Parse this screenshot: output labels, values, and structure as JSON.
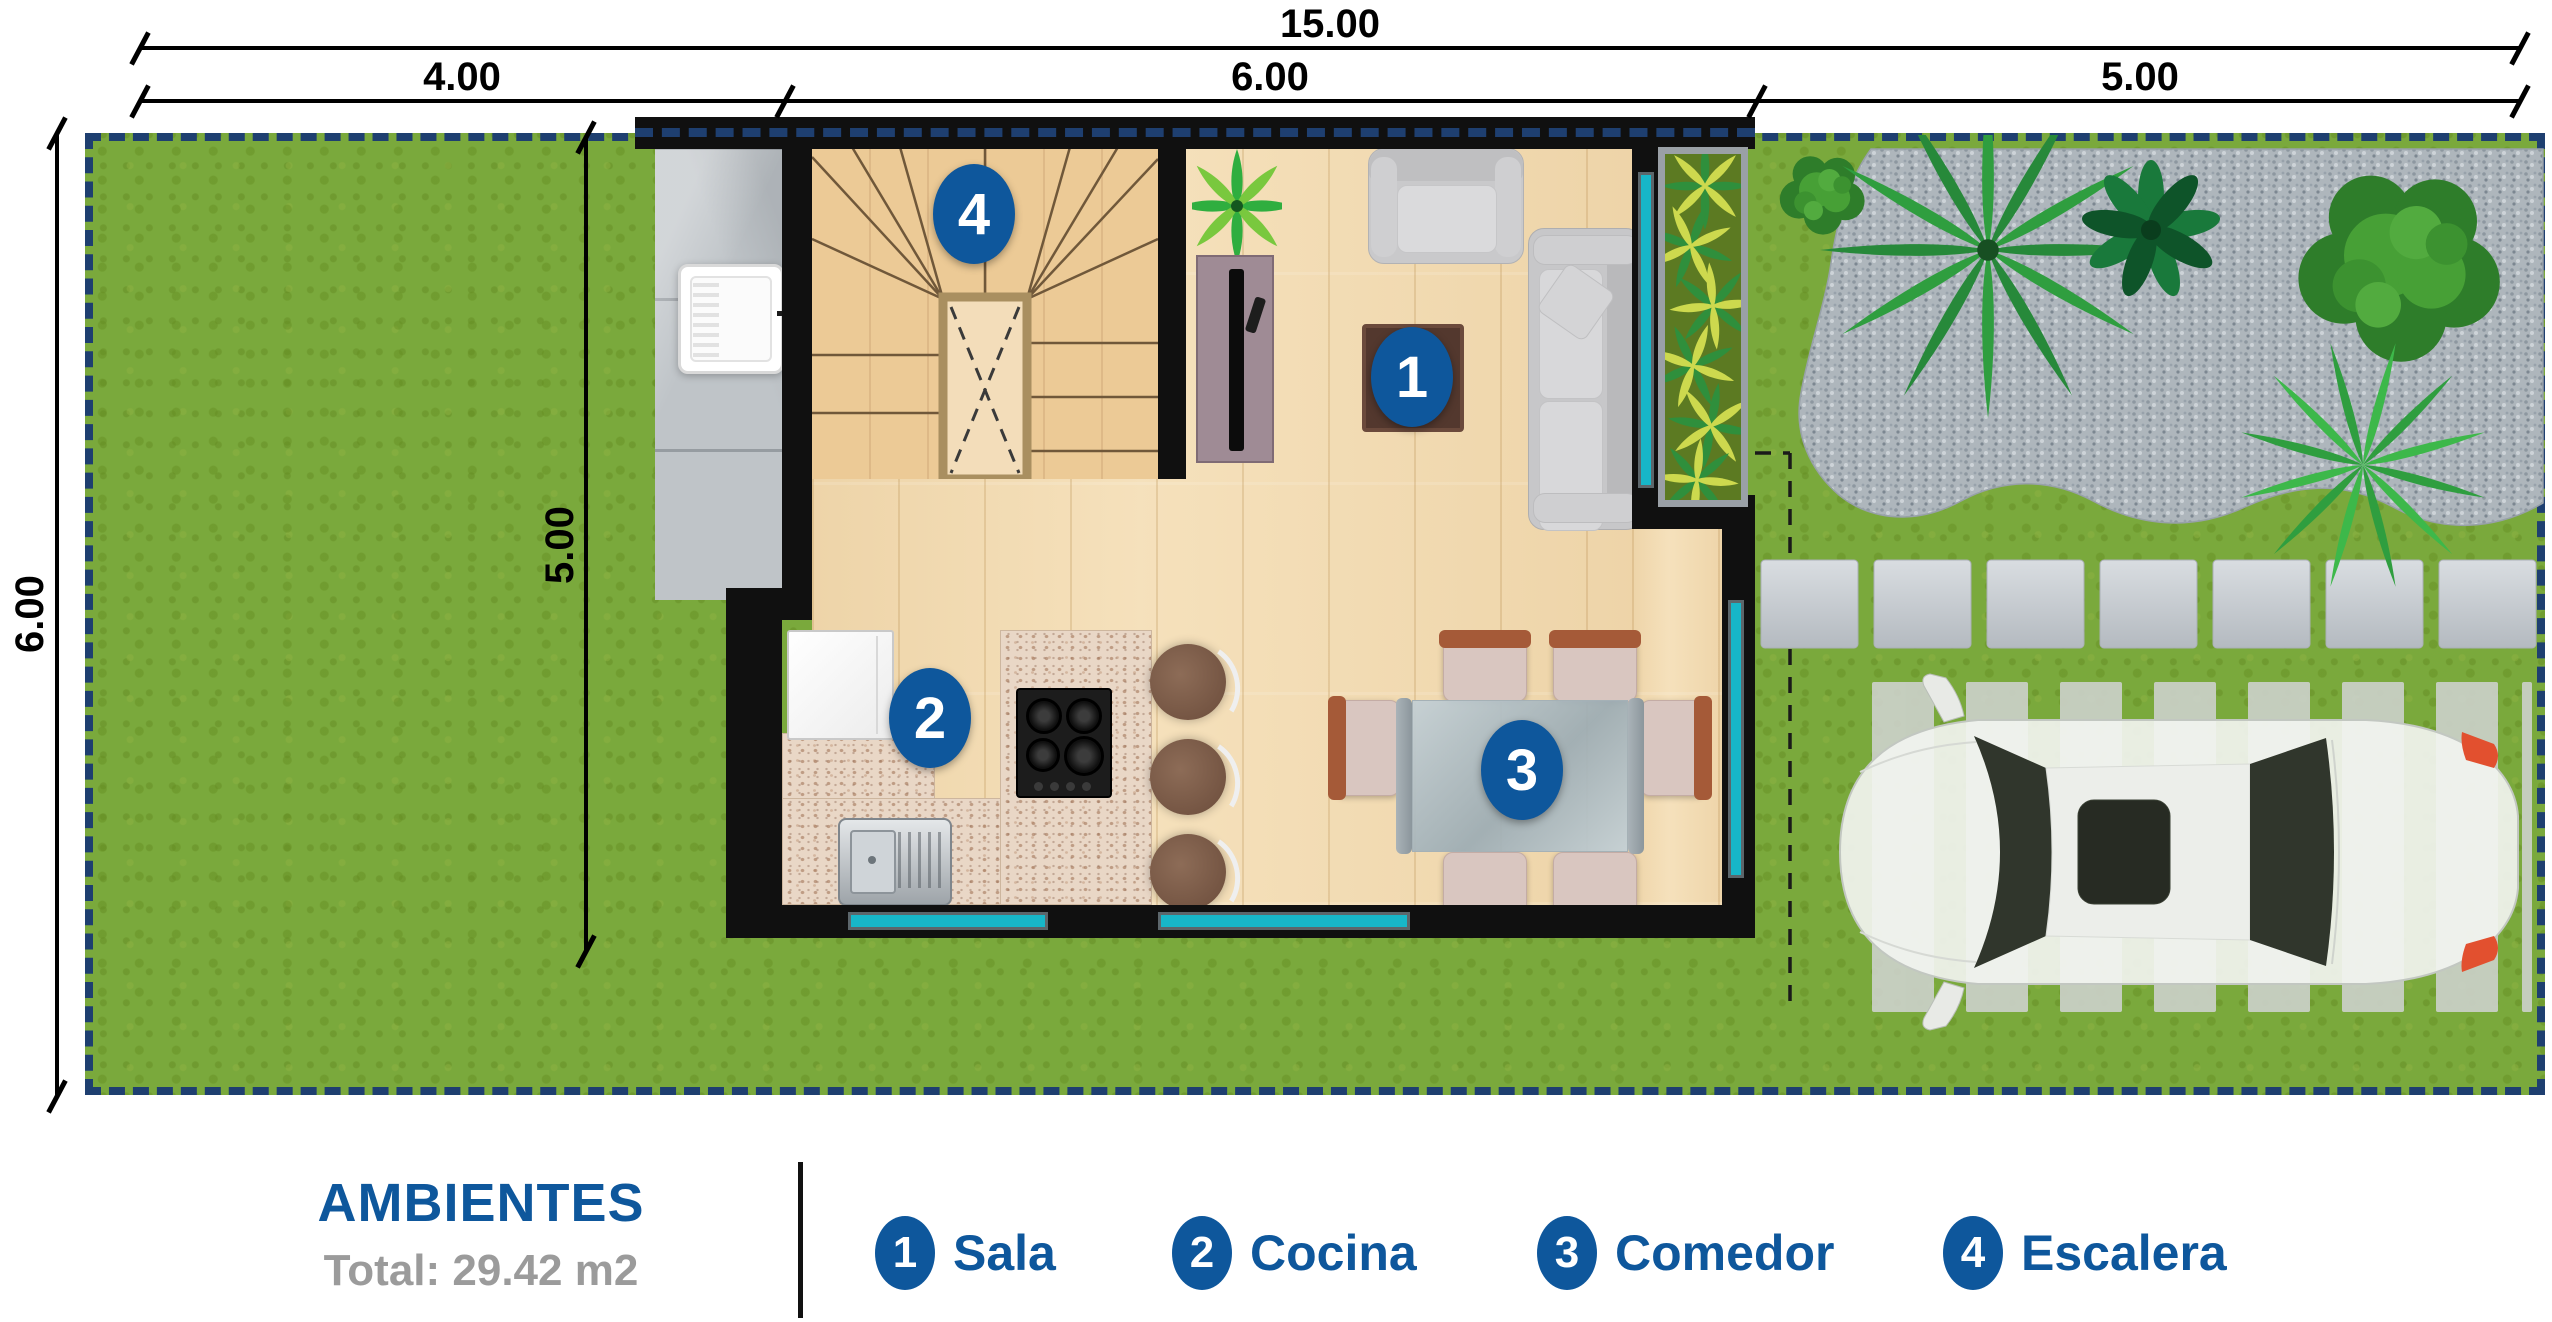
{
  "dimensions": {
    "total_width_m": "15.00",
    "segments_top": [
      "4.00",
      "6.00",
      "5.00"
    ],
    "lot_height_m": "6.00",
    "house_depth_m": "5.00"
  },
  "rooms": [
    {
      "num": "1",
      "label": "Sala"
    },
    {
      "num": "2",
      "label": "Cocina"
    },
    {
      "num": "3",
      "label": "Comedor"
    },
    {
      "num": "4",
      "label": "Escalera"
    }
  ],
  "legend": {
    "title": "AMBIENTES",
    "total_label": "Total: 29.42 m2"
  },
  "colors": {
    "accent_blue": "#0e579c",
    "boundary_navy": "#1e3f70",
    "window_teal": "#17b6c8",
    "grass_green": "#7aa93c",
    "gravel_gray": "#aeb6bc",
    "wall_black": "#101010",
    "wood_floor": "#f3ddb6",
    "counter_terrazzo": "#e9d7c6",
    "muted_gray_text": "#9b9b9b"
  }
}
